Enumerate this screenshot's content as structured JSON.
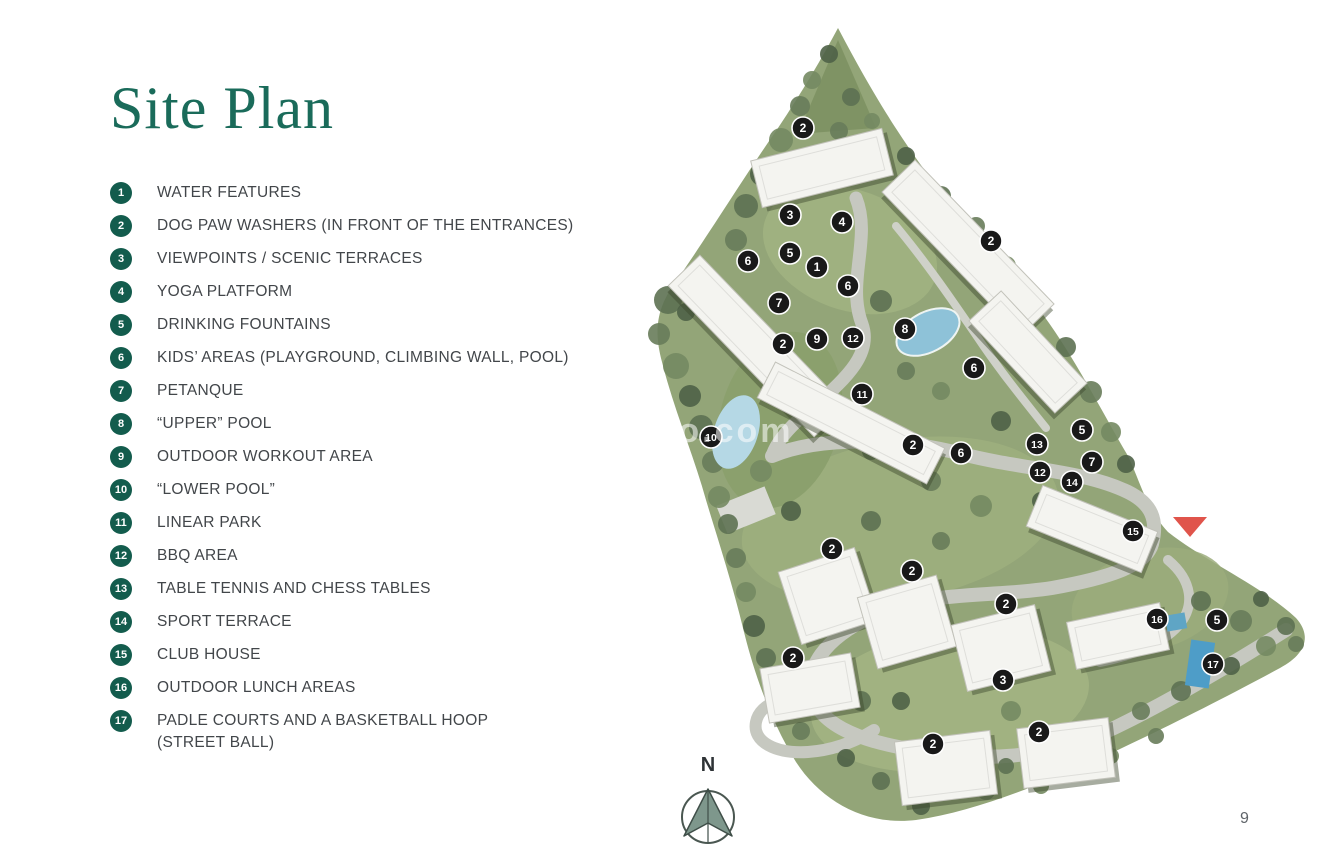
{
  "page": {
    "title": "Site Plan",
    "page_number": "9",
    "watermark": "o-toro.com",
    "compass_label": "N"
  },
  "colors": {
    "title_green": "#1a6b5a",
    "badge_green": "#135c4d",
    "legend_text": "#42464a",
    "marker_black": "#191919",
    "entrance_red": "#e0544b",
    "road_gray": "#c6c8c0",
    "terrain_green": "#93a578"
  },
  "legend": {
    "items": [
      {
        "number": "1",
        "label": "WATER FEATURES"
      },
      {
        "number": "2",
        "label": "DOG PAW WASHERS (IN FRONT OF THE ENTRANCES)"
      },
      {
        "number": "3",
        "label": "VIEWPOINTS / SCENIC TERRACES"
      },
      {
        "number": "4",
        "label": "YOGA PLATFORM"
      },
      {
        "number": "5",
        "label": "DRINKING FOUNTAINS"
      },
      {
        "number": "6",
        "label": "KIDS’ AREAS (PLAYGROUND, CLIMBING WALL, POOL)"
      },
      {
        "number": "7",
        "label": "PETANQUE"
      },
      {
        "number": "8",
        "label": "“UPPER” POOL"
      },
      {
        "number": "9",
        "label": "OUTDOOR WORKOUT AREA"
      },
      {
        "number": "10",
        "label": "“LOWER POOL”"
      },
      {
        "number": "11",
        "label": "LINEAR PARK"
      },
      {
        "number": "12",
        "label": "BBQ AREA"
      },
      {
        "number": "13",
        "label": "TABLE TENNIS AND CHESS TABLES"
      },
      {
        "number": "14",
        "label": "SPORT TERRACE"
      },
      {
        "number": "15",
        "label": "CLUB HOUSE"
      },
      {
        "number": "16",
        "label": "OUTDOOR LUNCH AREAS"
      },
      {
        "number": "17",
        "label": "PADLE COURTS AND A BASKETBALL HOOP",
        "label2": "(STREET BALL)"
      }
    ]
  },
  "map": {
    "markers": [
      {
        "n": "2",
        "x": 803,
        "y": 128
      },
      {
        "n": "3",
        "x": 790,
        "y": 215
      },
      {
        "n": "4",
        "x": 842,
        "y": 222
      },
      {
        "n": "2",
        "x": 991,
        "y": 241
      },
      {
        "n": "5",
        "x": 790,
        "y": 253
      },
      {
        "n": "6",
        "x": 748,
        "y": 261
      },
      {
        "n": "1",
        "x": 817,
        "y": 267
      },
      {
        "n": "6",
        "x": 848,
        "y": 286
      },
      {
        "n": "7",
        "x": 779,
        "y": 303
      },
      {
        "n": "8",
        "x": 905,
        "y": 329
      },
      {
        "n": "12",
        "x": 853,
        "y": 338
      },
      {
        "n": "9",
        "x": 817,
        "y": 339
      },
      {
        "n": "2",
        "x": 783,
        "y": 344
      },
      {
        "n": "6",
        "x": 974,
        "y": 368
      },
      {
        "n": "11",
        "x": 862,
        "y": 394
      },
      {
        "n": "5",
        "x": 1082,
        "y": 430
      },
      {
        "n": "10",
        "x": 711,
        "y": 437
      },
      {
        "n": "13",
        "x": 1037,
        "y": 444
      },
      {
        "n": "2",
        "x": 913,
        "y": 445
      },
      {
        "n": "6",
        "x": 961,
        "y": 453
      },
      {
        "n": "7",
        "x": 1092,
        "y": 462
      },
      {
        "n": "12",
        "x": 1040,
        "y": 472
      },
      {
        "n": "14",
        "x": 1072,
        "y": 482
      },
      {
        "n": "15",
        "x": 1133,
        "y": 531
      },
      {
        "n": "2",
        "x": 832,
        "y": 549
      },
      {
        "n": "2",
        "x": 912,
        "y": 571
      },
      {
        "n": "2",
        "x": 1006,
        "y": 604
      },
      {
        "n": "16",
        "x": 1157,
        "y": 619
      },
      {
        "n": "5",
        "x": 1217,
        "y": 620
      },
      {
        "n": "2",
        "x": 793,
        "y": 658
      },
      {
        "n": "17",
        "x": 1213,
        "y": 664
      },
      {
        "n": "3",
        "x": 1003,
        "y": 680
      },
      {
        "n": "2",
        "x": 1039,
        "y": 732
      },
      {
        "n": "2",
        "x": 933,
        "y": 744
      }
    ],
    "entrance_triangle": {
      "x": 1190,
      "y": 527
    }
  }
}
